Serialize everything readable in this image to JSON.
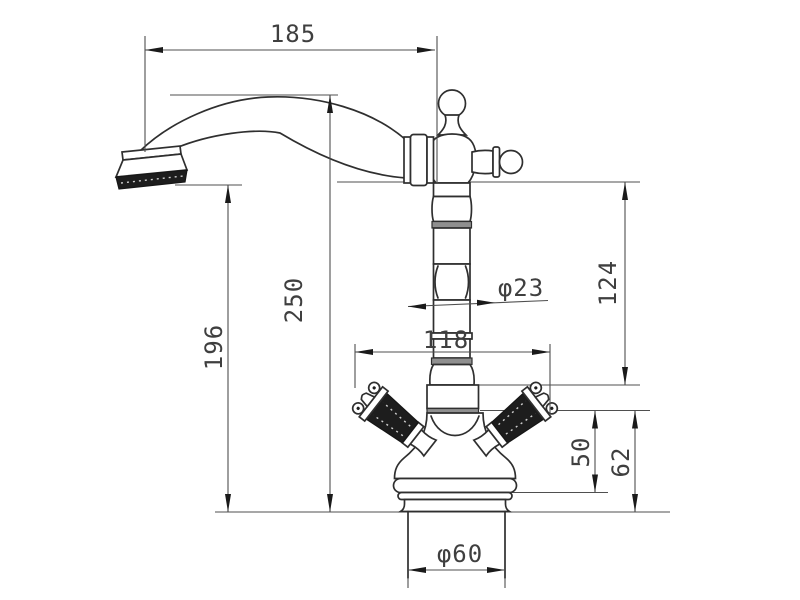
{
  "drawing": {
    "kind": "faucet technical dimension drawing",
    "dimensions": {
      "spout_reach": "185",
      "overall_height": "250",
      "spout_outlet_height": "196",
      "upper_body_height": "124",
      "column_diameter": "φ23",
      "handle_span": "118",
      "collar_height": "50",
      "body_base_height": "62",
      "base_diameter": "φ60"
    },
    "colors": {
      "object_line": "#2f2f2f",
      "dimension_line": "#4f4f4f",
      "background": "#ffffff",
      "band_gray": "#8f8f8f",
      "dark_fill": "#1d1d1d"
    }
  }
}
